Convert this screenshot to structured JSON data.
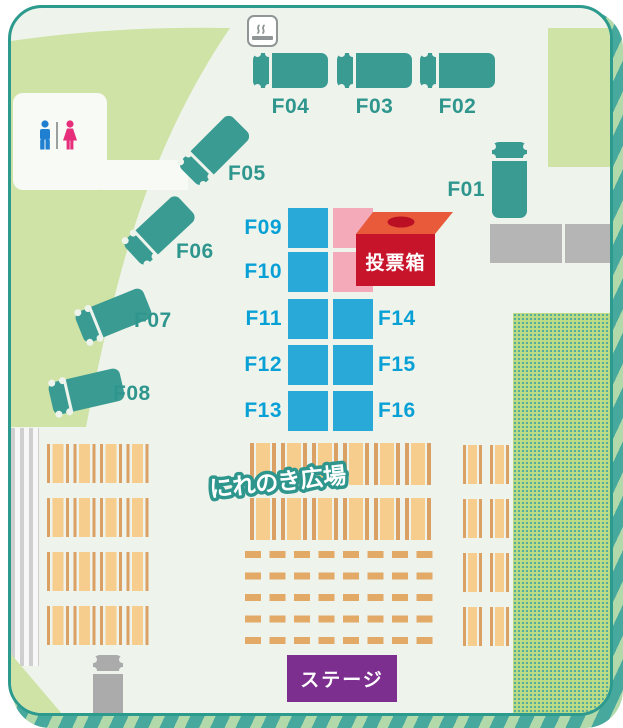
{
  "areas": {
    "plaza_label": "にれのき広場",
    "stage_label": "ステージ",
    "voting_box_label": "投票箱"
  },
  "food_trucks": {
    "f01": "F01",
    "f02": "F02",
    "f03": "F03",
    "f04": "F04",
    "f05": "F05",
    "f06": "F06",
    "f07": "F07",
    "f08": "F08"
  },
  "booths": {
    "f09": "F09",
    "f10": "F10",
    "f11": "F11",
    "f12": "F12",
    "f13": "F13",
    "f14": "F14",
    "f15": "F15",
    "f16": "F16"
  },
  "icons": {
    "smoking": "smoking-area-icon",
    "restroom_men": "men-restroom-icon",
    "restroom_women": "women-restroom-icon"
  },
  "colors": {
    "truck_teal": "#3a9b93",
    "booth_blue": "#29a9d8",
    "booth_pink": "#f4aab9",
    "voting_box_red": "#c8142b",
    "voting_box_top": "#e85a3a",
    "stage_purple": "#7c2f8e",
    "bench_orange": "#f7cd8e",
    "lawn_green": "#cfe3a6",
    "border_teal": "#2d9a8e",
    "label_teal": "#2f968e",
    "label_blue": "#09a0d6"
  }
}
